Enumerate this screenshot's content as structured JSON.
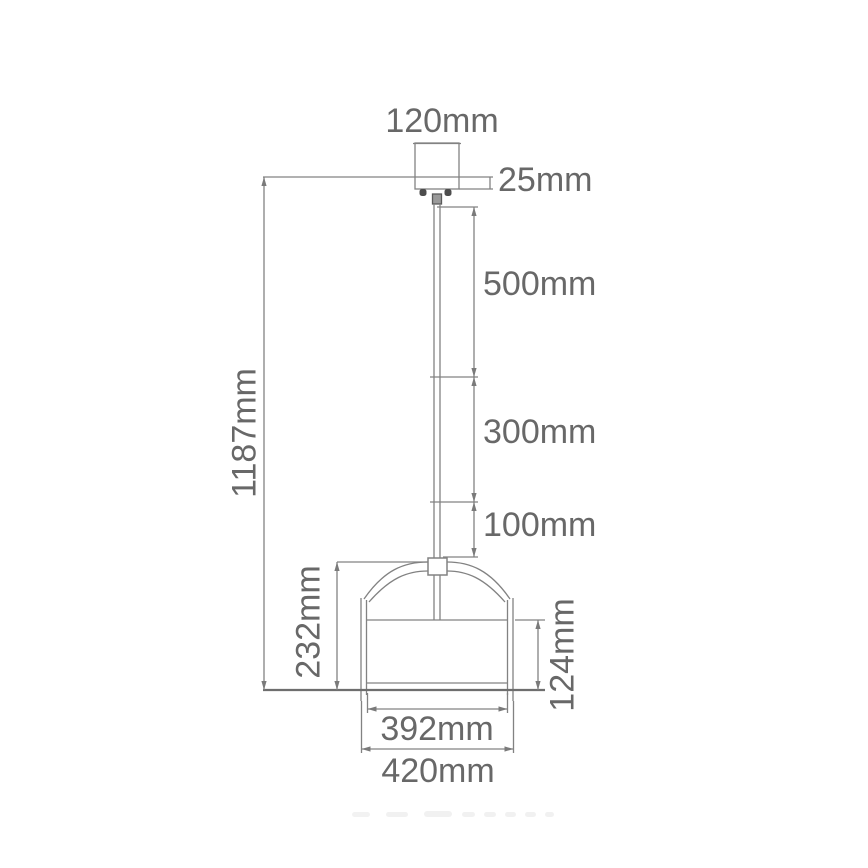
{
  "diagram": {
    "labels": {
      "canopy_width": "120mm",
      "canopy_height": "25mm",
      "rod_section_upper": "500mm",
      "rod_section_middle": "300mm",
      "rod_section_lower": "100mm",
      "overall_height": "1187mm",
      "shade_total_height": "232mm",
      "drum_height": "124mm",
      "shade_inner_width": "392mm",
      "shade_outer_width": "420mm"
    },
    "colors": {
      "line": "#828282",
      "thick_line": "#6e6e6e",
      "dark_detail": "#4d4d4d",
      "text": "#686868",
      "background": "#ffffff"
    }
  }
}
